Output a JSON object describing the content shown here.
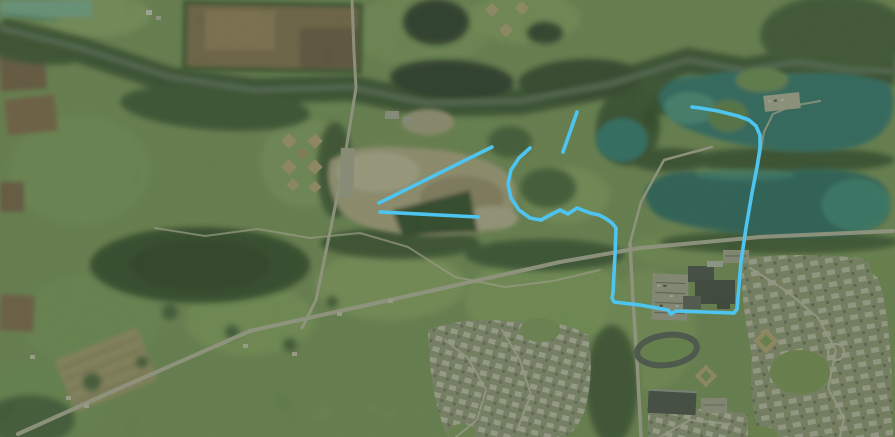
{
  "view": {
    "type": "satellite-aerial-imagery",
    "visible_text": "",
    "width_px": 895,
    "height_px": 437
  },
  "palette": {
    "annotation_color": "#4dc5f0",
    "field_green": "#7d9c5b",
    "forest_dark": "#2b4726",
    "lake_teal": "#1a7478",
    "dirt_tan": "#c6b695",
    "road_gray": "#ccc7b8"
  },
  "visible_features": [
    "winding river with forested banks across top",
    "brown farm fields top-left",
    "baseball-diamond cloverleaf complex left-center",
    "dirt quarry / gravel pit center-left",
    "teal quarry lakes right",
    "school campus with track and ball diamonds lower-right",
    "residential subdivisions bottom-center and right",
    "diagonal rural road from bottom-left to right edge"
  ],
  "annotations": {
    "color": "#4dc5f0",
    "stroke_width": 3.6,
    "paths": [
      {
        "name": "highlight-quarry-diagonal",
        "points": "379,203 492,147"
      },
      {
        "name": "highlight-quarry-baseline",
        "points": "380,212 478,217"
      },
      {
        "name": "highlight-short-segment",
        "points": "577,112 563,152"
      },
      {
        "name": "highlight-loop-route",
        "points": "530,148 519,158 511,170 508,184 511,198 519,210 530,218 541,220 552,214 560,210 568,214 577,208 590,213 599,215 605,218 612,223 616,228 615,255 613,293 612,298 614,302 640,305 668,310 671,314 676,311 705,312 734,313 737,309 741,262 746,228 752,193 757,167 760,148 760,135 756,126 749,120 738,116 718,111 700,108 692,107"
      }
    ]
  }
}
